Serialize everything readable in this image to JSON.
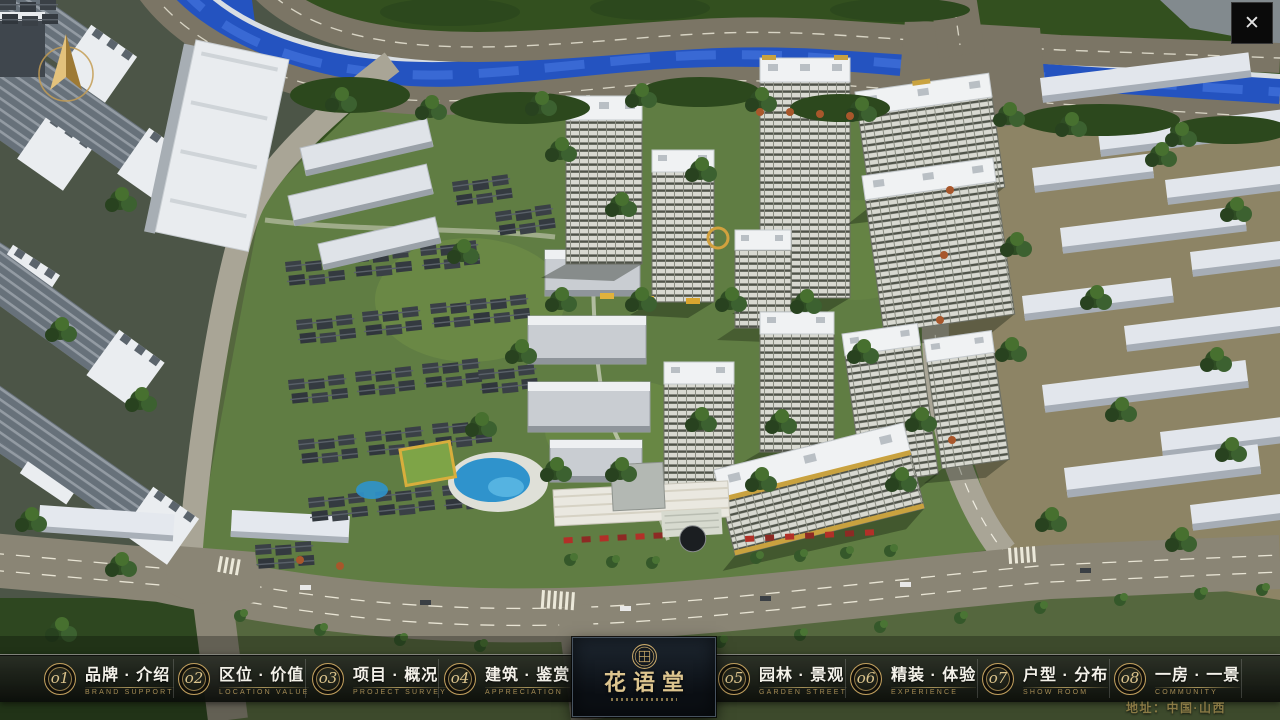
{
  "window": {
    "close_label": "✕"
  },
  "logo": {
    "name": "花语堂",
    "seal": "seal-emblem-icon"
  },
  "nav": {
    "items": [
      {
        "num": "o1",
        "title": "品牌 · 介绍",
        "subtitle": "BRAND SUPPORT"
      },
      {
        "num": "o2",
        "title": "区位 · 价值",
        "subtitle": "LOCATION VALUE"
      },
      {
        "num": "o3",
        "title": "项目 · 概况",
        "subtitle": "PROJECT SURVEY"
      },
      {
        "num": "o4",
        "title": "建筑 · 鉴赏",
        "subtitle": "APPRECIATION"
      },
      {
        "num": "o5",
        "title": "园林 · 景观",
        "subtitle": "GARDEN STREET"
      },
      {
        "num": "o6",
        "title": "精装 · 体验",
        "subtitle": "EXPERIENCE"
      },
      {
        "num": "o7",
        "title": "户型 · 分布",
        "subtitle": "SHOW ROOM"
      },
      {
        "num": "o8",
        "title": "一房 · 一景",
        "subtitle": "COMMUNITY"
      }
    ]
  },
  "footer": {
    "address": "地址：中国·山西"
  },
  "colors": {
    "gold": "#c9a35f",
    "navbar_bg": "rgba(16,20,15,0.85)",
    "river": "#2453c0"
  }
}
